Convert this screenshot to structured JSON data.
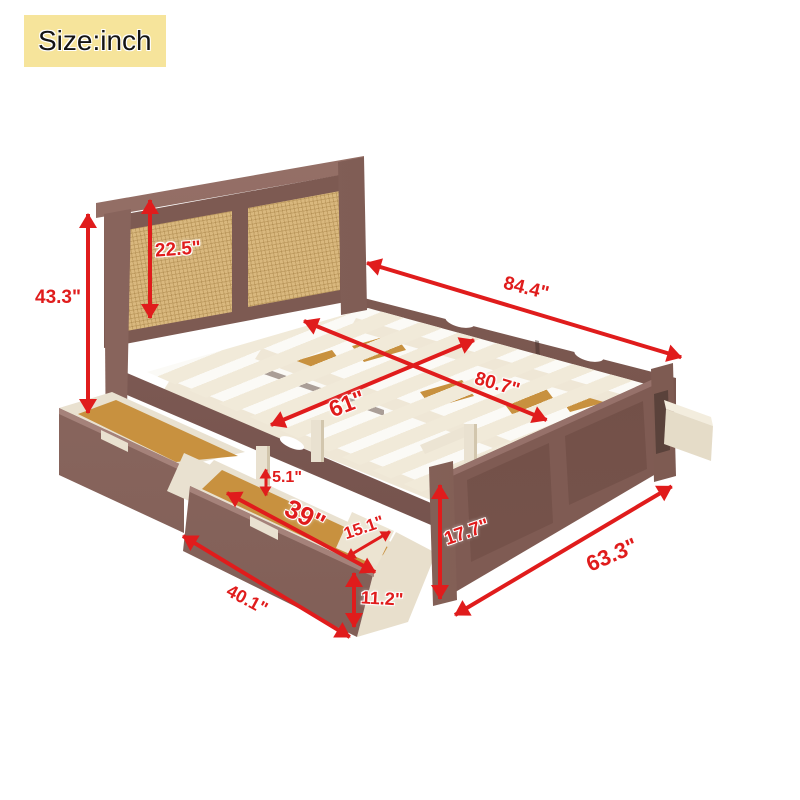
{
  "badge": {
    "label": "Size:inch",
    "bg_color": "#f6e49b"
  },
  "annotation": {
    "arrow_color": "#e01c1c"
  },
  "dims": {
    "headboard_height": "43.3\"",
    "headboard_panel_height": "22.5\"",
    "overall_length": "84.4\"",
    "slat_area_length": "80.7\"",
    "bed_width": "61\"",
    "drawer_divider_height": "5.1\"",
    "drawer_inner_length": "39\"",
    "drawer_depth": "15.1\"",
    "footboard_height": "17.7\"",
    "side_rail_length": "63.3\"",
    "drawer_outer_length": "40.1\"",
    "drawer_front_height": "11.2\""
  },
  "materials": {
    "wood_brown": "#7d5a52",
    "rattan_tan": "#d9b87e",
    "slat_cream": "#f1ead9",
    "drawer_bottom_tan": "#c8913f",
    "drawer_interior_cream": "#e9e1d0"
  }
}
